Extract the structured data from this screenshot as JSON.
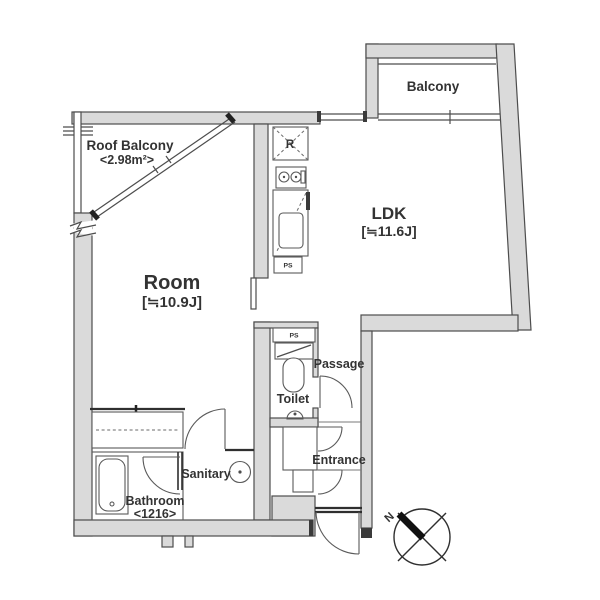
{
  "rooms": {
    "roof_balcony": {
      "name": "Roof Balcony",
      "area": "<2.98m²>"
    },
    "balcony": {
      "name": "Balcony"
    },
    "ldk": {
      "name": "LDK",
      "size": "[≒11.6J]"
    },
    "room": {
      "name": "Room",
      "size": "[≒10.9J]"
    },
    "passage": {
      "name": "Passage"
    },
    "toilet": {
      "name": "Toilet"
    },
    "sanitary": {
      "name": "Sanitary"
    },
    "bathroom": {
      "name": "Bathroom",
      "size": "<1216>"
    },
    "entrance": {
      "name": "Entrance"
    }
  },
  "fixtures": {
    "refrigerator": "R",
    "pipe_space_kitchen": "PS",
    "pipe_space_toilet": "PS"
  },
  "compass": {
    "north": "N"
  },
  "colors": {
    "wall_fill": "#dadada",
    "wall_line": "#4d4d4d",
    "text": "#333333",
    "background": "#ffffff"
  }
}
